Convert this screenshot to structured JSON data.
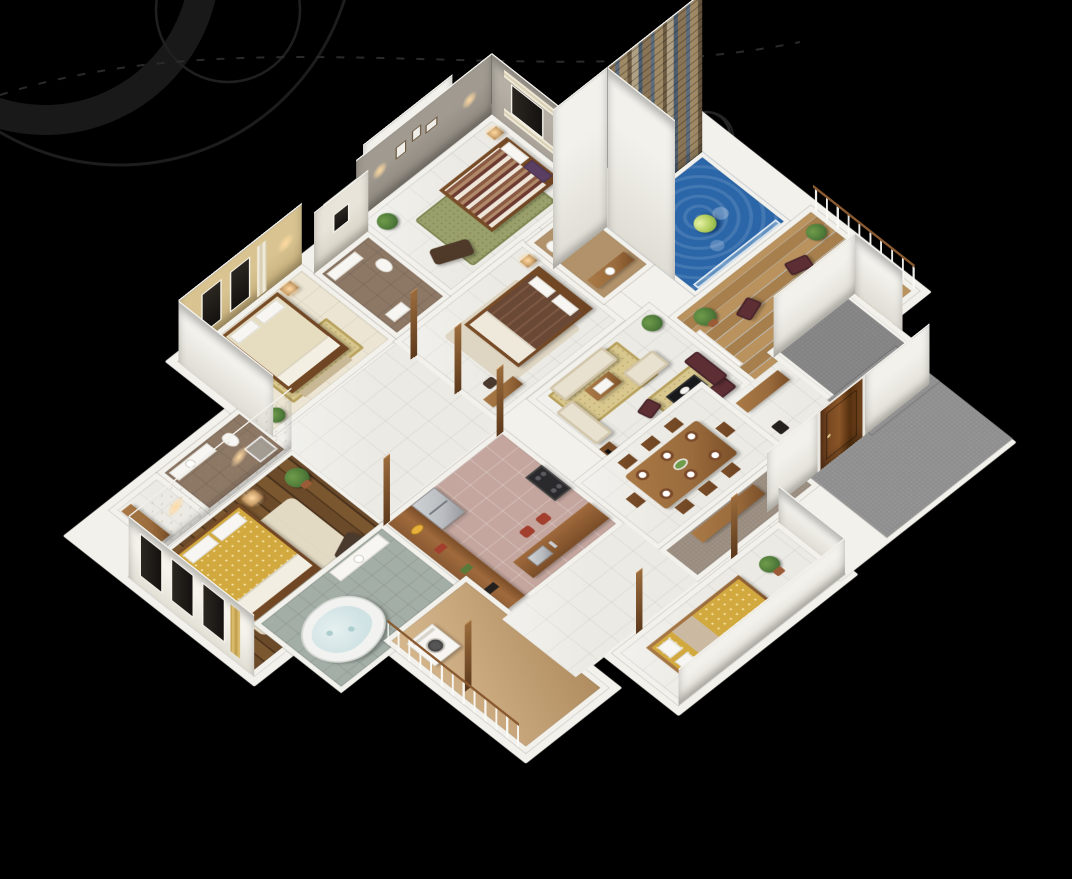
{
  "scene": {
    "type": "isometric-3d-floor-plan-render",
    "description": "Photorealistic dollhouse-style 3D render of a four-bedroom house floor plan viewed from above at an angle, on a black background with faint swirl ornaments in the upper left",
    "background_color": "#000000",
    "visible_text": "none"
  },
  "palette": {
    "bg": "#000000",
    "swirl": "#222222",
    "wallWhite": "#f2f1ec",
    "wallShade": "#dfddd4",
    "tile": "#ebeae4",
    "creamFloor": "#ece5d3",
    "woodA": "#6b4a2a",
    "woodB": "#52371d",
    "deckA": "#b9925e",
    "deckB": "#a67f4c",
    "woodFurn": "#9a6b3c",
    "woodDark": "#6e4423",
    "kitchenTile": "#c4a69e",
    "bathTile": "#a3aea6",
    "brownTile": "#8d7765",
    "tanWood": "#b1926a",
    "carpet": "#8f8f8f",
    "famCarpet": "#9a8d80",
    "balconyTan": "#c9a87e",
    "poolA": "#2a66a8",
    "poolB": "#5e9bd2",
    "ball": "#aecb5a",
    "stone1": "#8a7456",
    "stone2": "#5f6c7c",
    "stone3": "#a08a66",
    "stone4": "#6d5b43",
    "bedGold": "#d2a93e",
    "bedCream": "#e6dcc0",
    "bedBrown": "#6a4836",
    "stripeMaroon": "#6d3a32",
    "sofaCream": "#e9e1cf",
    "sofaMaroon": "#5d2f35",
    "rugGold": "#d9c88e",
    "rugOlive": "#9aa06b",
    "plant": "#4e7a3a",
    "plantLight": "#6f9c4a",
    "clay": "#9c5b37",
    "glow": "#ffd9a0",
    "door": "#7a4a22",
    "rail": "#8a5a30",
    "steel": "#b9bcc0",
    "beigeWall": "#d9c491",
    "grayWall": "#a09a90",
    "grayWallLight": "#b5afa5",
    "marble": "#e8e4da",
    "floral": "#f1ede2",
    "waterTub": "#cfe2e4"
  },
  "rooms": [
    {
      "id": "master-bedroom",
      "label": "Master bedroom with gold patterned double bed on dark wood plank floor"
    },
    {
      "id": "master-bathroom",
      "label": "Master bathroom with brown tile, toilet and shower"
    },
    {
      "id": "wardrobe-hall",
      "label": "Wardrobe hallway"
    },
    {
      "id": "bedroom-2",
      "label": "Second bedroom with cream double bed and beige feature wall"
    },
    {
      "id": "bathroom-2",
      "label": "Central bathroom with brown tile floor"
    },
    {
      "id": "bedroom-3",
      "label": "Third bedroom with maroon striped bed, olive rug and chaise"
    },
    {
      "id": "north-balcony",
      "label": "Small north balcony"
    },
    {
      "id": "bedroom-4",
      "label": "Fourth bedroom with brown double bed"
    },
    {
      "id": "bathroom-3",
      "label": "En-suite bathroom with vanity"
    },
    {
      "id": "swimming-pool",
      "label": "Plunge pool with floating ball and tall stone feature wall"
    },
    {
      "id": "sun-deck",
      "label": "Timber sun deck with four lounge chairs, round table, plants and railing"
    },
    {
      "id": "living-room",
      "label": "Living room with cream sofa set, maroon leather set, rugs and TV unit"
    },
    {
      "id": "dining-area",
      "label": "Dining area with eight-seat wooden table set with plates"
    },
    {
      "id": "kitchen",
      "label": "Kitchen with long counter, fridge, hob, island sink and stools"
    },
    {
      "id": "jacuzzi-bathroom",
      "label": "Bathroom with heart-shaped jacuzzi tub and vanity"
    },
    {
      "id": "utility-balcony",
      "label": "Utility balcony with washing machine and wood railing"
    },
    {
      "id": "family-room",
      "label": "Carpeted family room with wooden console"
    },
    {
      "id": "rear-balcony",
      "label": "Rear balcony with gold daybed mattress and potted plant"
    },
    {
      "id": "entrance-porch",
      "label": "Grey carpeted entrance porch with wooden front door"
    },
    {
      "id": "store-room",
      "label": "Grey carpeted store room"
    },
    {
      "id": "hallway",
      "label": "Glossy white tiled hallway"
    }
  ],
  "objects": [
    "double-bed-gold",
    "double-bed-cream",
    "double-bed-striped",
    "double-bed-brown",
    "daybed-gold-mattress",
    "chaise-lounge",
    "armchair",
    "nightstands-with-lamps",
    "cream-sofa-set",
    "maroon-leather-sofa-set",
    "black-coffee-table",
    "wood-coffee-table",
    "tv-unit",
    "dining-table-8-chairs",
    "plates-and-salad-bowl",
    "kitchen-counter",
    "refrigerator",
    "cooktop",
    "island-sink",
    "red-stools",
    "heart-jacuzzi-tub",
    "washing-machine",
    "toilets",
    "vanity-basins",
    "shower-cabin",
    "pool-ball",
    "deck-chairs-4",
    "round-deck-table",
    "potted-plants",
    "front-door",
    "wood-railing",
    "stone-feature-wall",
    "picture-frames"
  ]
}
